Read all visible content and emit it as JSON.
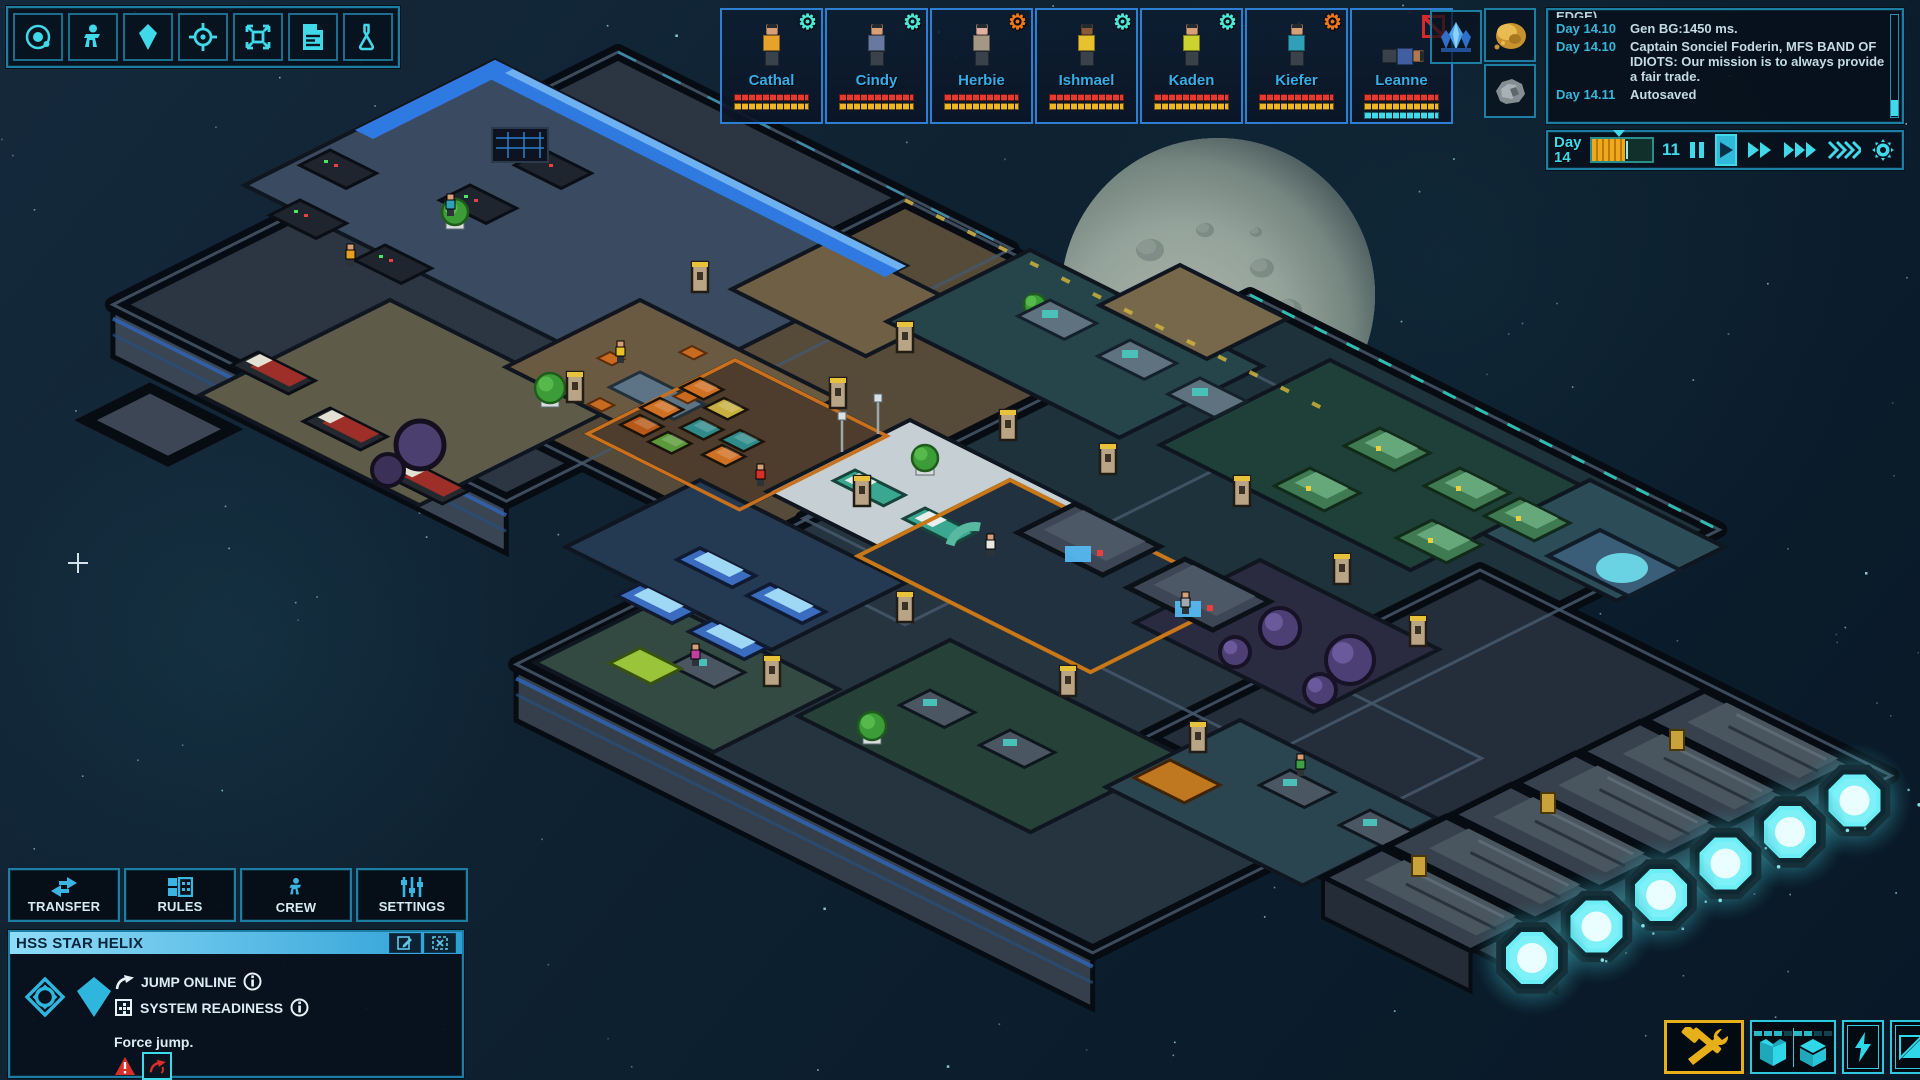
{
  "hud": {
    "accent_color": "#3fd9ea",
    "toolbar": {
      "items": [
        {
          "icon": "orbit-system-icon"
        },
        {
          "icon": "crew-person-icon"
        },
        {
          "icon": "resource-crystal-icon"
        },
        {
          "icon": "target-crosshair-icon"
        },
        {
          "icon": "expand-view-icon"
        },
        {
          "icon": "report-document-icon"
        },
        {
          "icon": "research-flask-icon"
        }
      ]
    },
    "crew_roster": [
      {
        "name": "Cathal",
        "status_icon": "gear",
        "status_color": "#49e8d8",
        "shirt": "#e6a22a",
        "skin": "#d8a078",
        "pose": "standing",
        "bars": [
          "#e8392f",
          "#edb623"
        ]
      },
      {
        "name": "Cindy",
        "status_icon": "gear",
        "status_color": "#49e8d8",
        "shirt": "#68789e",
        "skin": "#d8a078",
        "pose": "standing",
        "bars": [
          "#e8392f",
          "#edb623"
        ]
      },
      {
        "name": "Herbie",
        "status_icon": "gear",
        "status_color": "#f07818",
        "shirt": "#a39884",
        "skin": "#e0b0a0",
        "pose": "standing",
        "bars": [
          "#e8392f",
          "#edb623"
        ]
      },
      {
        "name": "Ishmael",
        "status_icon": "gear",
        "status_color": "#49e8d8",
        "shirt": "#e8c22c",
        "skin": "#8a5a38",
        "pose": "standing",
        "bars": [
          "#e8392f",
          "#edb623"
        ]
      },
      {
        "name": "Kaden",
        "status_icon": "gear",
        "status_color": "#49e8d8",
        "shirt": "#cdd32e",
        "skin": "#d8a078",
        "pose": "standing",
        "bars": [
          "#e8392f",
          "#edb623"
        ]
      },
      {
        "name": "Kiefer",
        "status_icon": "gear",
        "status_color": "#f07818",
        "shirt": "#2fa0b8",
        "skin": "#d8a078",
        "pose": "standing",
        "bars": [
          "#e8392f",
          "#edb623"
        ]
      },
      {
        "name": "Leanne",
        "status_icon": "disabled",
        "status_color": "#d42a2a",
        "shirt": "#3f5fa0",
        "skin": "#b07850",
        "pose": "lying",
        "bars": [
          "#e8392f",
          "#edb623",
          "#3fd9ea"
        ]
      }
    ],
    "resources": [
      {
        "icon": "crystal-cluster-icon"
      },
      {
        "icon": "gold-ore-icon"
      },
      {
        "icon": "rock-ore-icon"
      }
    ],
    "event_log": {
      "clipped_line": "EDGE)",
      "entries": [
        {
          "day": "Day 14.10",
          "text": "Gen BG:1450 ms."
        },
        {
          "day": "Day 14.10",
          "text": "Captain Sonciel Foderin, MFS BAND OF IDIOTS:  Our mission is to always provide a fair trade."
        },
        {
          "day": "Day 14.11",
          "text": "Autosaved"
        }
      ]
    },
    "time_panel": {
      "day_label": "Day",
      "day_value": "14",
      "counter": "11",
      "progress_pct": 55,
      "marker_pct": 46,
      "tick_pct": 57
    },
    "ship_menu": {
      "tabs": [
        {
          "label": "TRANSFER",
          "icon": "transfer-arrows-icon"
        },
        {
          "label": "RULES",
          "icon": "rules-grid-icon"
        },
        {
          "label": "CREW",
          "icon": "crew-person-icon"
        },
        {
          "label": "SETTINGS",
          "icon": "sliders-icon"
        }
      ]
    },
    "ship_panel": {
      "name": "HSS STAR HELIX",
      "statuses": [
        {
          "label": "JUMP ONLINE",
          "icon": "jump-arrow-icon"
        },
        {
          "label": "SYSTEM READINESS",
          "icon": "readiness-grid-icon"
        }
      ],
      "hint": "Force jump."
    },
    "build_menu": {
      "highlight_color": "#e8b018",
      "buttons": [
        {
          "icon": "build-tools-icon",
          "highlighted": true
        },
        {
          "icon": "storage-open-box-icon",
          "bars": [
            1,
            1,
            1,
            0
          ]
        },
        {
          "icon": "storage-cube-icon",
          "bars": [
            1,
            1,
            0,
            0
          ]
        },
        {
          "icon": "power-bolt-icon"
        },
        {
          "icon": "hull-view-icon"
        }
      ]
    }
  }
}
